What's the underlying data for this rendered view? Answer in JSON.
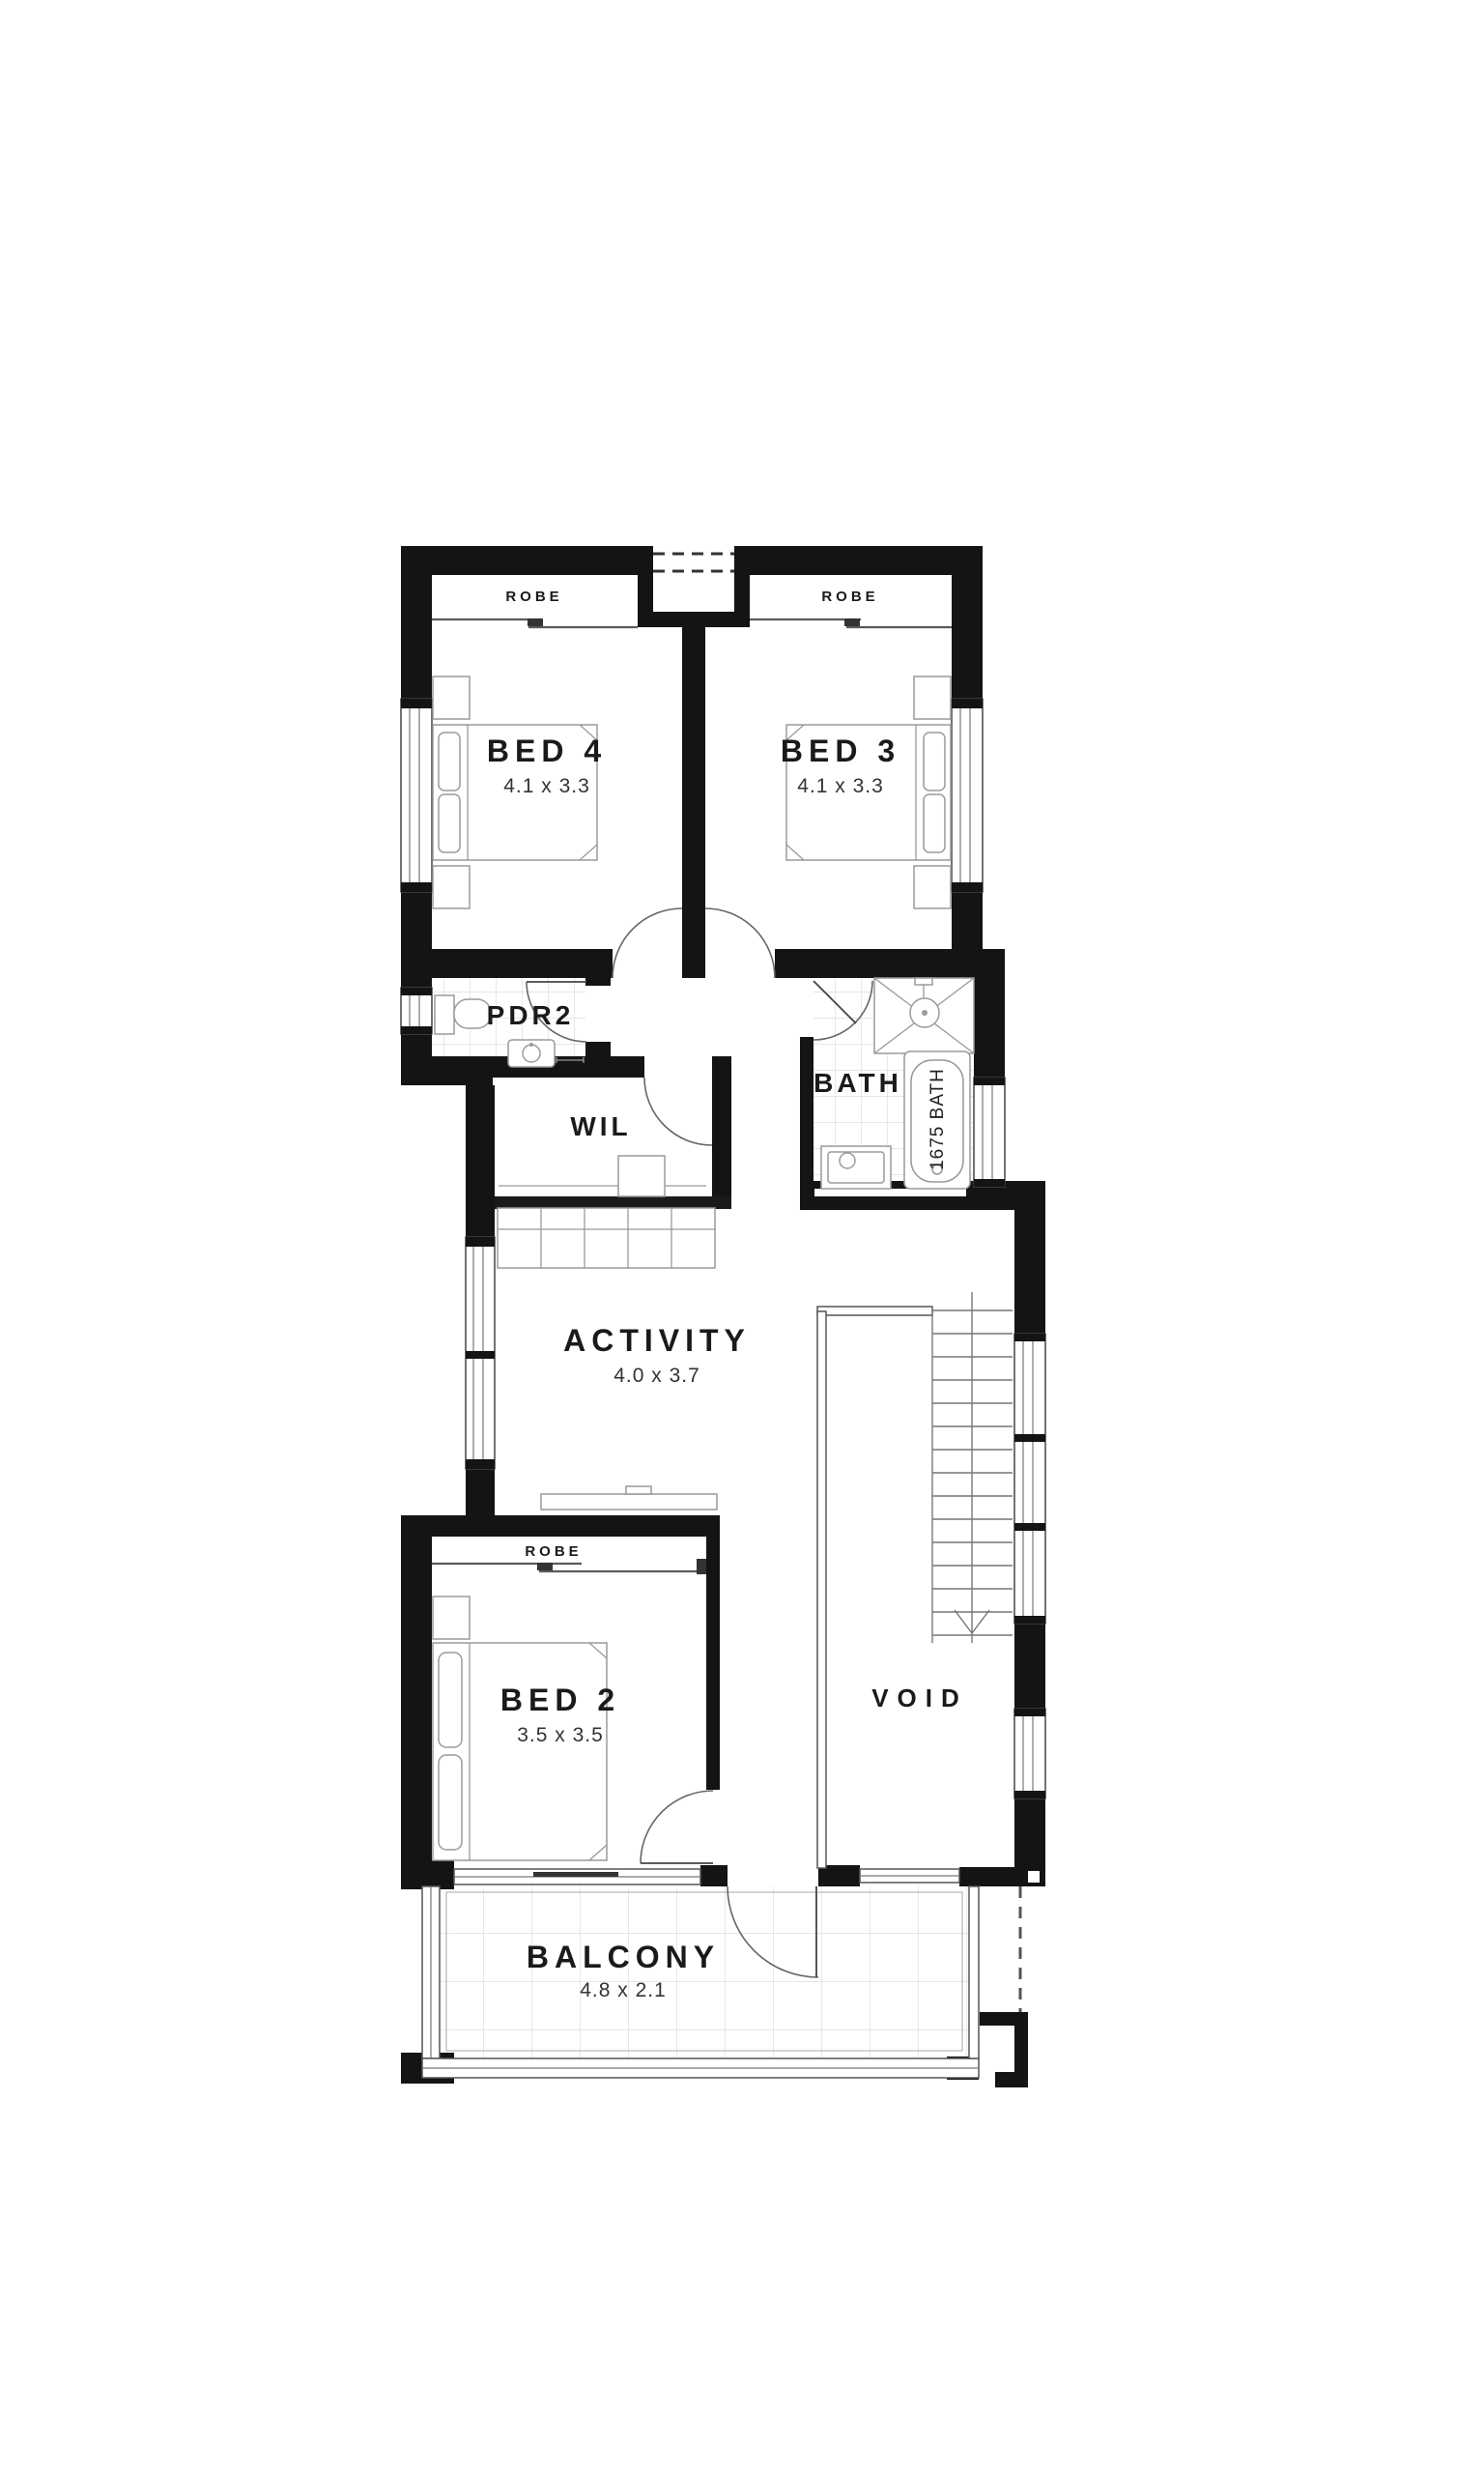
{
  "plan": {
    "type": "floor-plan",
    "rooms": {
      "robe_left": {
        "label": "ROBE"
      },
      "robe_right": {
        "label": "ROBE"
      },
      "bed4": {
        "label": "BED 4",
        "dims": "4.1 x 3.3"
      },
      "bed3": {
        "label": "BED 3",
        "dims": "4.1 x 3.3"
      },
      "pdr2": {
        "label": "PDR2"
      },
      "wil": {
        "label": "WIL"
      },
      "bath": {
        "label": "BATH"
      },
      "tub": {
        "label": "1675 BATH"
      },
      "activity": {
        "label": "ACTIVITY",
        "dims": "4.0 x 3.7"
      },
      "robe_bed2": {
        "label": "ROBE"
      },
      "bed2": {
        "label": "BED 2",
        "dims": "3.5 x 3.5"
      },
      "void": {
        "label": "VOID"
      },
      "balcony": {
        "label": "BALCONY",
        "dims": "4.8 x 2.1"
      }
    },
    "colors": {
      "wall": "#141414",
      "line": "#8a8a8a",
      "tile": "#d8d8d8",
      "background": "#ffffff",
      "text": "#1a1a1a"
    }
  }
}
